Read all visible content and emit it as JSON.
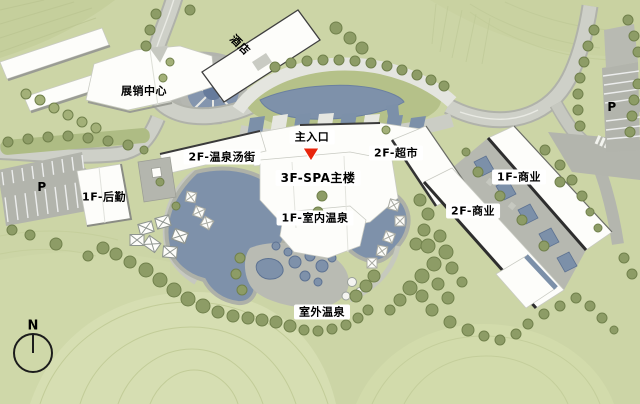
{
  "plan": {
    "type": "resort-master-site-plan",
    "labels": {
      "hotel": "酒店",
      "exhibition_center": "展销中心",
      "main_entrance": "主入口",
      "hot_spring_street": "2F-温泉汤街",
      "supermarket": "2F-超市",
      "spa_main_building": "3F-SPA主楼",
      "commerce_1f": "1F-商业",
      "commerce_2f": "2F-商业",
      "logistics": "1F-后勤",
      "indoor_hot_spring": "1F-室内温泉",
      "outdoor_hot_spring": "室外温泉",
      "parking_left": "P",
      "parking_right": "P",
      "compass_north": "N"
    },
    "colors": {
      "grass": "#ccd5a6",
      "grass_light": "#d8e0b4",
      "tree": "#8d9c66",
      "road": "#ced0c8",
      "road_dark": "#b0b2aa",
      "water": "#7e91aa",
      "building": "#fdfdfa",
      "building_edge": "#3a3a3a",
      "entrance_marker": "#e8250c",
      "label_text": "#000000",
      "label_chip": "#ffffff"
    }
  }
}
